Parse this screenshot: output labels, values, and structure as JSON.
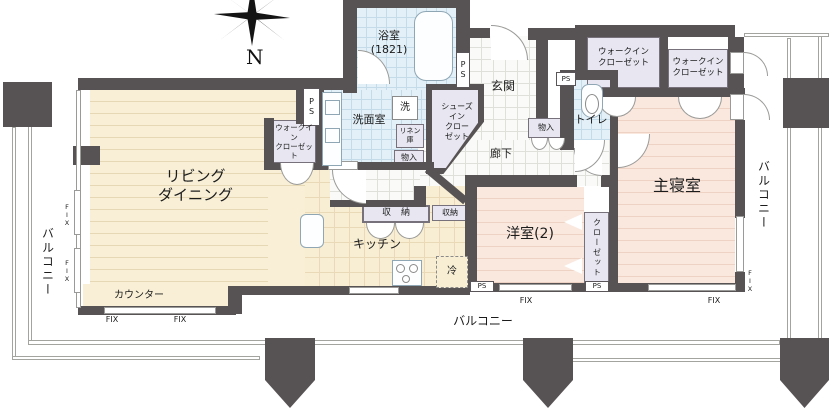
{
  "compass": {
    "north": "N"
  },
  "rooms": {
    "living": {
      "label": "リビング\nダイニング"
    },
    "kitchen": {
      "label": "キッチン"
    },
    "counter": {
      "label": "カウンター"
    },
    "bath": {
      "label": "浴室\n(1821)"
    },
    "washroom": {
      "label": "洗面室"
    },
    "toilet": {
      "label": "トイレ"
    },
    "genkan": {
      "label": "玄関"
    },
    "corridor": {
      "label": "廊下"
    },
    "master_bedroom": {
      "label": "主寝室"
    },
    "bedroom2": {
      "label": "洋室(2)"
    },
    "closet": {
      "label": "クローゼット"
    },
    "wic_master_1": {
      "label": "ウォークイン\nクローゼット"
    },
    "wic_master_2": {
      "label": "ウォークイン\nクローゼット"
    },
    "wic_living": {
      "label": "ウォークイン\nクローゼット"
    },
    "shoes_closet": {
      "label": "シューズ\nイン\nクロー\nゼット"
    }
  },
  "storage": {
    "linen": {
      "label": "リネン\n庫"
    },
    "monoire_washroom": {
      "label": "物入"
    },
    "monoire_hall": {
      "label": "物入"
    },
    "shuno_wide": {
      "label": "収納"
    },
    "shuno": {
      "label": "収納"
    }
  },
  "fixtures": {
    "washer": {
      "label": "洗"
    },
    "fridge": {
      "label": "冷"
    }
  },
  "balcony": {
    "left": {
      "label": "バルコニー"
    },
    "bottom": {
      "label": "バルコニー"
    },
    "right": {
      "label": "バルコニー"
    }
  },
  "annotations": {
    "ps": "PS",
    "ps_vertical": "P\nS",
    "fix": "FIX",
    "fix_vertical": "F\nI\nX"
  },
  "colors": {
    "wall": "#575253",
    "living_floor": "#f8efd6",
    "bedroom_floor": "#fae8df",
    "wet_floor": "#e4f0f7",
    "closet_floor": "#e7e6f1",
    "tile_floor": "#fafaf8"
  }
}
